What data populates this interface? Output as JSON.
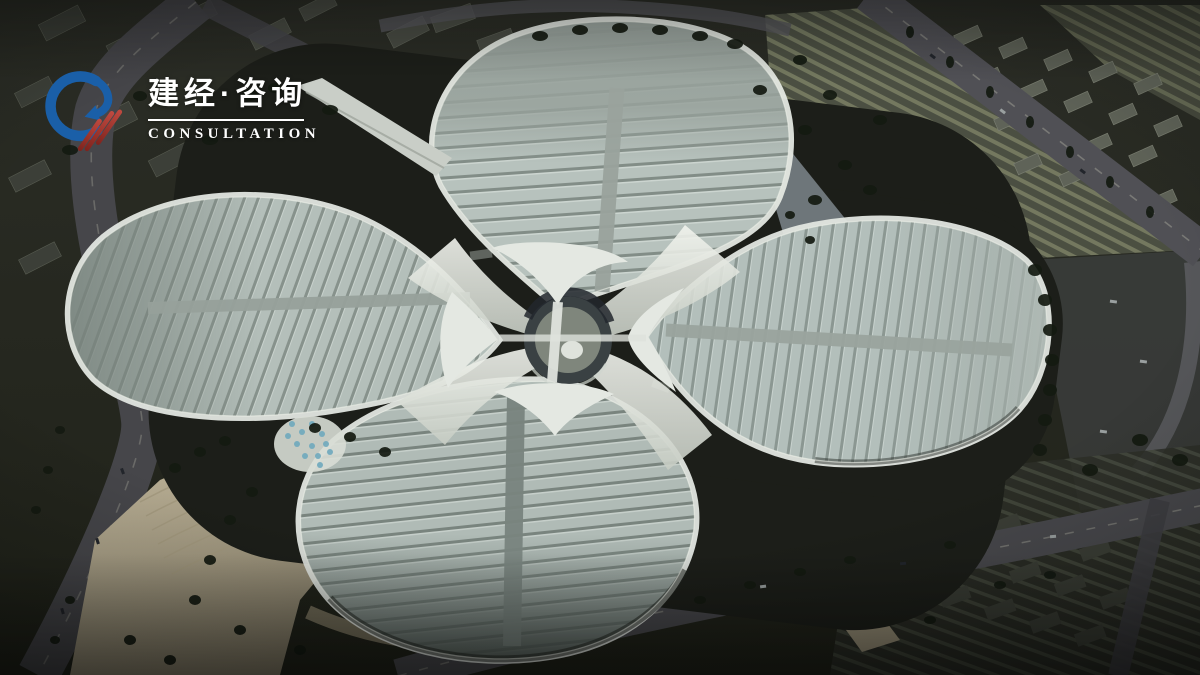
{
  "image": {
    "type": "aerial-architectural-rendering",
    "subject": "Bird's-eye 3D rendering of a four-leaf-clover exhibition and convention center complex with a central circular hub, surrounded by roads, parking lots, plazas and city blocks at dusk"
  },
  "watermark": {
    "brand_cn": "建经·咨询",
    "brand_en": "CONSULTATION"
  },
  "palette": {
    "logo_blue": "#1a5fa8",
    "logo_red": "#a8322a",
    "text_white": "#ffffff",
    "roof_light": "#b7c2bd",
    "roof_shadow": "#828d87",
    "roof_spine_gray": "#9aa39d",
    "canopy_white": "#e8ebe5",
    "ground_dark": "#24261f",
    "road_gray": "#47474b",
    "plaza_tan": "#c0b59a",
    "tree_green": "#151b11",
    "skylight_blue": "#6fa9bd"
  }
}
